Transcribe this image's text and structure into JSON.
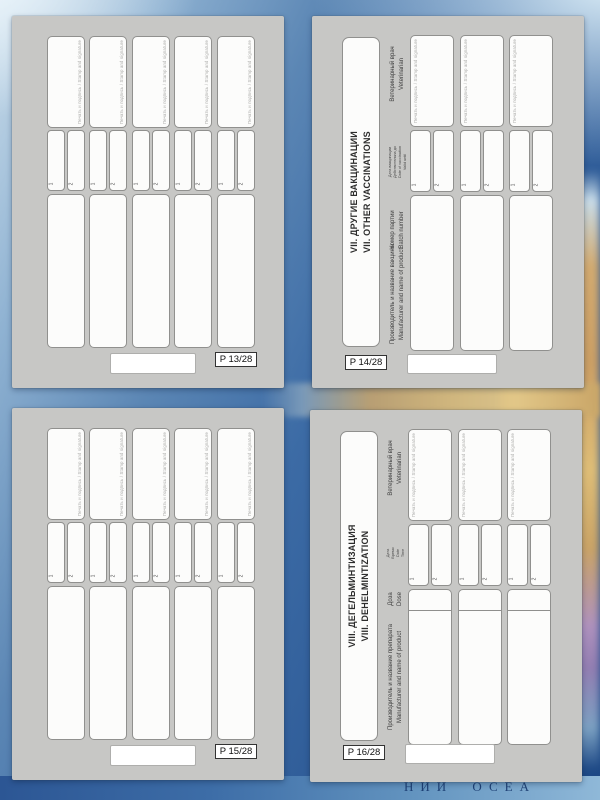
{
  "background": {
    "ocean_label_fragment": "НИЙ  ОСЕА",
    "sea_label_fragment": "Lapt"
  },
  "shared": {
    "stamp_note": "Печать и подпись / Stamp and signature",
    "cell_1": "1",
    "cell_2": "2"
  },
  "page13": {
    "page_label": "P 13/28"
  },
  "page14": {
    "page_label": "P 14/28",
    "title_ru": "VII. ДРУГИЕ ВАКЦИНАЦИИ",
    "title_en": "VII. OTHER VACCINATIONS",
    "header_vet_ru": "Ветеринарный врач",
    "header_vet_en": "Veterinarian",
    "header_date_ru": "Дата вакцинации",
    "header_valid_ru": "Действительна до",
    "header_date_en": "Date of vaccination",
    "header_valid_en": "Valid until",
    "header_batch_ru": "Номер партии",
    "header_batch_en": "Batch number",
    "header_manufacturer_ru": "Производитель и название вакцины",
    "header_manufacturer_en": "Manufacturer and name of product"
  },
  "page15": {
    "page_label": "P 15/28"
  },
  "page16": {
    "page_label": "P 16/28",
    "title_ru": "VIII. ДЕГЕЛЬМИНТИЗАЦИЯ",
    "title_en": "VIII. DEHELMINTIZATION",
    "header_vet_ru": "Ветеринарный врач",
    "header_vet_en": "Veterinarian",
    "header_date_ru": "Дата",
    "header_time_ru": "Время",
    "header_date_en": "Date",
    "header_time_en": "Time",
    "header_dose_ru": "Доза",
    "header_dose_en": "Dose",
    "header_manufacturer_ru": "Производитель и название препарата",
    "header_manufacturer_en": "Manufacturer and name of product"
  }
}
